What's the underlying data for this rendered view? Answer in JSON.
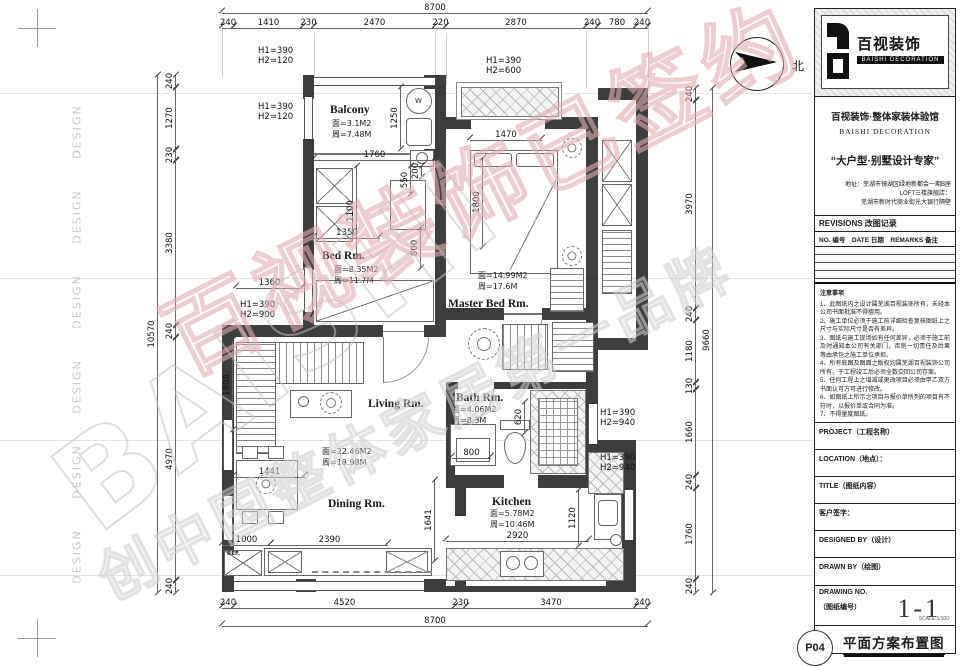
{
  "page": {
    "north_label": "北",
    "design_label": "DESIGN"
  },
  "watermarks": {
    "latin": "BAISHI",
    "red_text": "百视装饰已签约",
    "gray_text": "创中国整体家居第一品牌"
  },
  "plan": {
    "rooms": {
      "balcony": {
        "name": "Balcony",
        "area": "面=3.1M2",
        "perimeter": "周=7.48M"
      },
      "bed": {
        "name": "Bed Rm.",
        "area": "面=8.35M2",
        "perimeter": "周=11.7M"
      },
      "master": {
        "name": "Master Bed Rm.",
        "area": "面=14.99M2",
        "perimeter": "周=17.6M"
      },
      "living": {
        "name": "Living Rm.",
        "area": "面=22.46M2",
        "perimeter": "周=18.98M"
      },
      "bath": {
        "name": "Bath Rm.",
        "area": "面=4.06M2",
        "perimeter": "周=8.3M"
      },
      "dining": {
        "name": "Dining Rm."
      },
      "kitchen": {
        "name": "Kitchen",
        "area": "面=5.78M2",
        "perimeter": "周=10.46M"
      }
    },
    "appliances": {
      "washer": "W",
      "fridge": "REF."
    },
    "dims": {
      "top_total": "8700",
      "top_segments": [
        "240",
        "1410",
        "230",
        "2470",
        "220",
        "2870",
        "240",
        "780",
        "240"
      ],
      "bottom_total": "8700",
      "bottom_segments": [
        "240",
        "4520",
        "230",
        "3470",
        "240"
      ],
      "left_total": "10570",
      "left_segments": [
        "240",
        "1270",
        "230",
        "3380",
        "240",
        "4970",
        "240"
      ],
      "right_total": "9660",
      "right_segments": [
        "240",
        "3970",
        "240",
        "1180",
        "130",
        "1660",
        "240",
        "1760",
        "240"
      ],
      "interior": {
        "balcony_door": "1760",
        "washer_niche": "1250",
        "bed_depth": "1100",
        "desk_a": "550",
        "desk_b": "200",
        "bed_width": "1350",
        "wardrobe": "800",
        "left_offset": "1360",
        "master_window": "1470",
        "master_bed": "1800",
        "sofa": "1808",
        "dining_table": "1441",
        "cabinet_a": "1000",
        "cabinet_b": "2390",
        "dining_h": "1641",
        "vanity": "800",
        "toilet": "620",
        "kitchen_h": "1120",
        "counter": "2920"
      }
    },
    "openings": [
      {
        "h1": "H1=390",
        "h2": "H2=120"
      },
      {
        "h1": "H1=390",
        "h2": "H2=120"
      },
      {
        "h1": "H1=390",
        "h2": "H2=600"
      },
      {
        "h1": "H1=390",
        "h2": "H2=900"
      },
      {
        "h1": "H1=390",
        "h2": "H2=940"
      },
      {
        "h1": "H1=390",
        "h2": "H2=940"
      }
    ]
  },
  "titleblock": {
    "brand": "百视装饰",
    "brand_en": "BAISHI DECORATION",
    "logo_tagline": "· · · · · · · · ·",
    "subtitle": "百视装饰·整体家装体验馆",
    "subtitle_en": "BAISHI DECORATION",
    "slogan": "“大户型·别墅设计专家”",
    "address_line1": "地址：芜湖市镜湖区绿地新都会一期B座",
    "address_line2": "LOFT三楼旗舰店：",
    "address_line3": "芜湖市新时代商业街光大银行隔壁",
    "revisions_title": "REVISIONS 改图记录",
    "revisions_cols": "NO. 编号　DATE 日期　REMARKS 备注",
    "notes_title": "注意事项",
    "notes": [
      "1、此图纸内之设计属芜湖百视装饰所有，未经本公司书面批准不得擅用。",
      "2、施工单位必须于施工前详细检查复核图纸上之尺寸与实际尺寸是否有差异。",
      "3、图纸与施工现场如有任何差异，必须于施工前及时通知本公司有关部门，否则一切责任及后果等由承包之施工单位承担。",
      "4、所有底图及图面之版权均属芜湖百视装饰公司所有，于工程竣工后必须全数交回公司存案。",
      "5、任何工程上之增减或更改项目必须由甲乙双方书面认可方可进行修改。",
      "6、如图纸上所示之项目与报价单所列的项目有不符时，以报价单或合同为准。",
      "7、不得量度图纸。"
    ],
    "project_label": "PROJECT（工程名称）",
    "location_label": "LOCATION（地点）：",
    "title_label": "TITLE（图纸内容）",
    "signature_label": "客户签字：",
    "designed_label": "DESIGNED BY（设计）",
    "drawn_label": "DRAWN BY（绘图）",
    "drawing_no_label": "DRAWING NO.",
    "drawing_no_label2": "（图纸编号）",
    "drawing_no": "1-1",
    "page_no": "P04",
    "sheet_title": "平面方案布置图",
    "scale": "SCALE:1/100"
  }
}
